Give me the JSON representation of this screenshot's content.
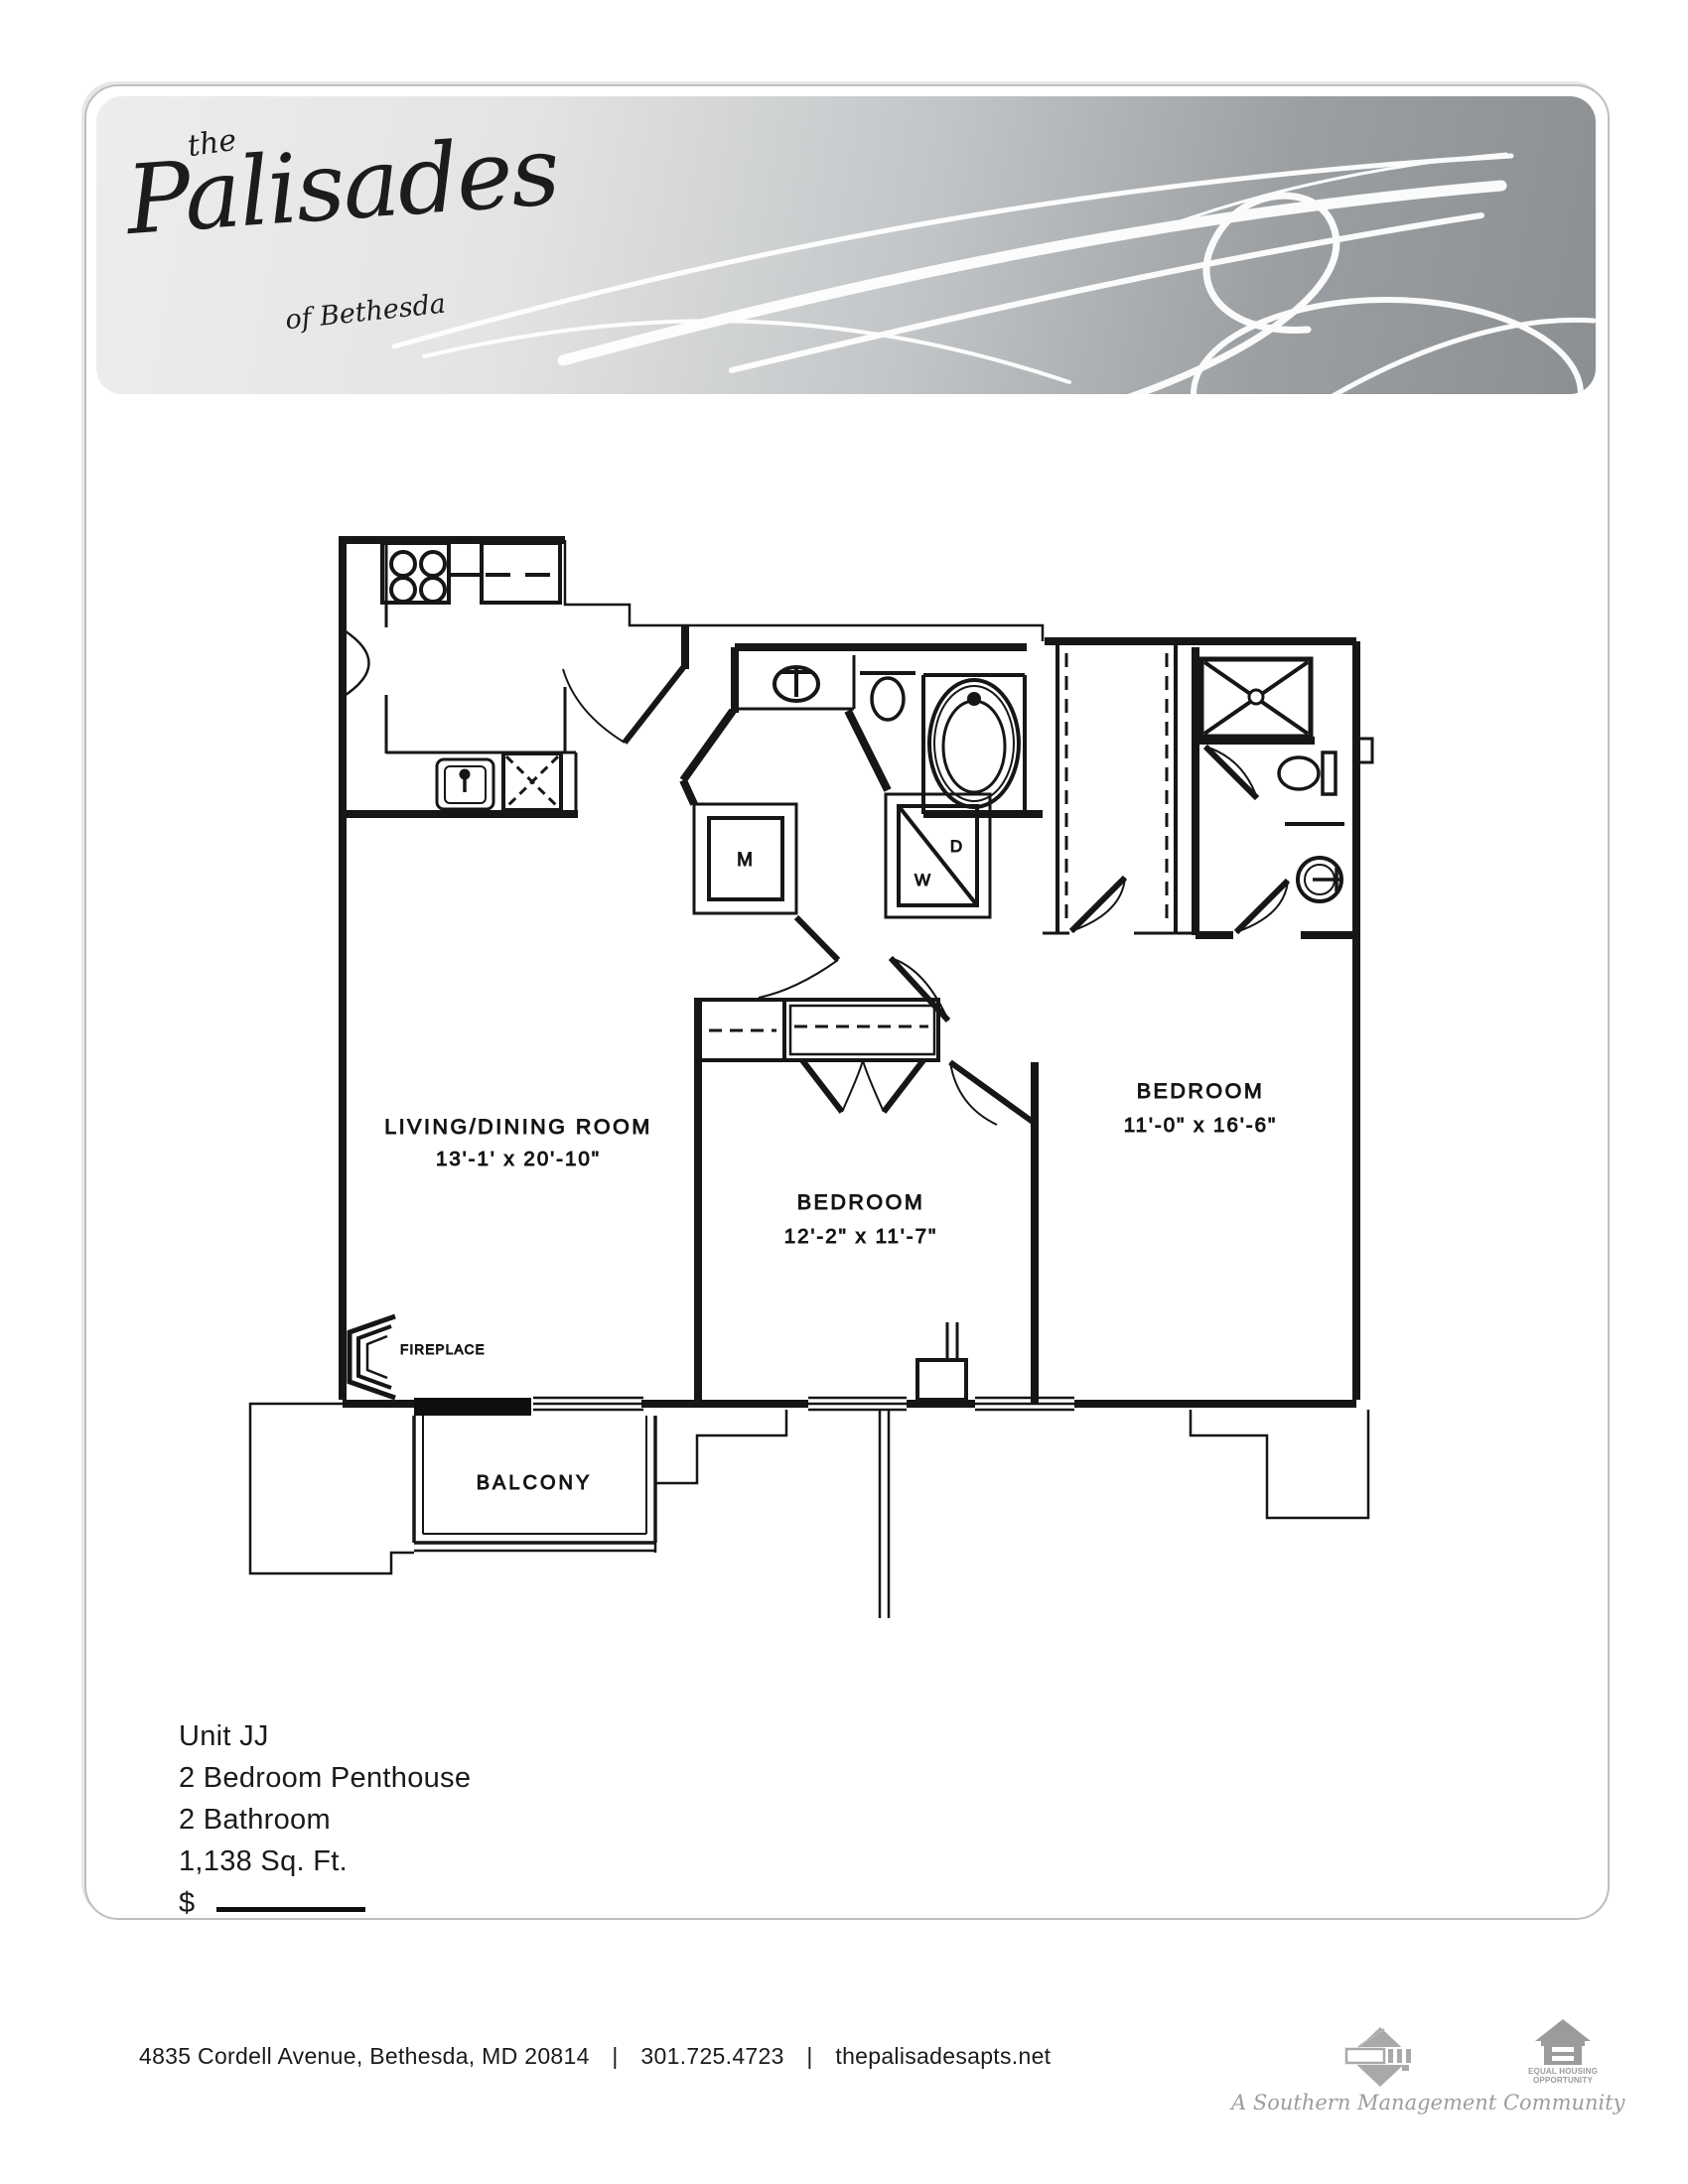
{
  "brand": {
    "pre": "the",
    "name": "Palisades",
    "suffix": "of Bethesda"
  },
  "plan": {
    "rooms": [
      {
        "name": "LIVING/DINING ROOM",
        "dims": "13'-1' x 20'-10\""
      },
      {
        "name": "BEDROOM",
        "dims": "12'-2\" x 11'-7\""
      },
      {
        "name": "BEDROOM",
        "dims": "11'-0\" x 16'-6\""
      }
    ],
    "labels": {
      "balcony": "BALCONY",
      "fireplace": "FIREPLACE",
      "mech": "M",
      "washer": "W",
      "dryer": "D"
    }
  },
  "unit": {
    "name": "Unit JJ",
    "type": "2 Bedroom Penthouse",
    "bath": "2 Bathroom",
    "area": "1,138 Sq. Ft.",
    "price_prefix": "$"
  },
  "footer": {
    "address": "4835 Cordell Avenue, Bethesda, MD 20814",
    "sep1": "|",
    "phone": "301.725.4723",
    "sep2": "|",
    "website": "thepalisadesapts.net",
    "community": "A Southern Management Community",
    "eho_line1": "EQUAL HOUSING",
    "eho_line2": "OPPORTUNITY"
  },
  "colors": {
    "banner_dark": "#8b8f92",
    "banner_light": "#ececec",
    "line": "#161616",
    "muted": "#9d9d9d"
  }
}
